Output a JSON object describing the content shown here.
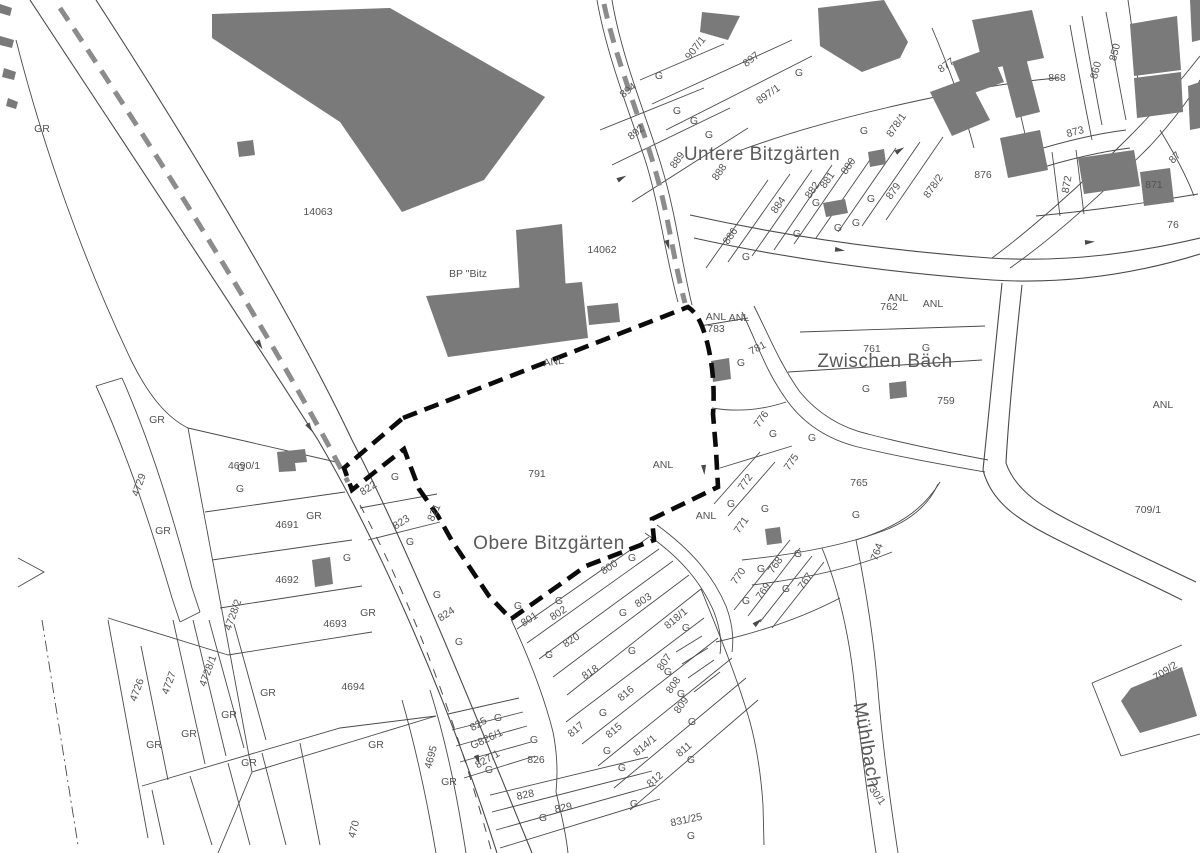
{
  "map": {
    "colors": {
      "background": "#ffffff",
      "building_fill": "#7a7a7a",
      "parcel_line": "#4a4a4a",
      "site_boundary": "#0b0b0b",
      "wall_dash": "#8c8c8c",
      "label_text": "#525252",
      "place_text": "#5a5a5a"
    },
    "place_names": [
      {
        "name": "label-untere-bitzgaerten",
        "t": "Untere Bitzgärten",
        "x": 762,
        "y": 160,
        "r": 0
      },
      {
        "name": "label-obere-bitzgaerten",
        "t": "Obere Bitzgärten",
        "x": 549,
        "y": 549,
        "r": 0
      },
      {
        "name": "label-zwischen-baech",
        "t": "Zwischen Bäch",
        "x": 885,
        "y": 367,
        "r": 0
      },
      {
        "name": "label-muehlbach",
        "t": "Mühlbach",
        "x": 861,
        "y": 746,
        "r": 80,
        "fs": 13
      }
    ],
    "labels": [
      {
        "t": "GR",
        "x": 42,
        "y": 132
      },
      {
        "t": "14063",
        "x": 318,
        "y": 215
      },
      {
        "t": "BP \"Bitz",
        "x": 468,
        "y": 277,
        "under": true,
        "name": "label-bp-bitzgaerten"
      },
      {
        "t": "14062",
        "x": 602,
        "y": 253
      },
      {
        "t": "GR",
        "x": 157,
        "y": 423
      },
      {
        "t": "4729",
        "x": 142,
        "y": 486,
        "r": -70
      },
      {
        "t": "4690/1",
        "x": 244,
        "y": 469
      },
      {
        "t": "G",
        "x": 241,
        "y": 471
      },
      {
        "t": "G",
        "x": 240,
        "y": 492
      },
      {
        "t": "GR",
        "x": 314,
        "y": 519
      },
      {
        "t": "4691",
        "x": 287,
        "y": 528
      },
      {
        "t": "GR",
        "x": 163,
        "y": 534
      },
      {
        "t": "G",
        "x": 347,
        "y": 561
      },
      {
        "t": "4692",
        "x": 287,
        "y": 583
      },
      {
        "t": "4693",
        "x": 335,
        "y": 627
      },
      {
        "t": "GR",
        "x": 368,
        "y": 616
      },
      {
        "t": "4694",
        "x": 353,
        "y": 690
      },
      {
        "t": "4728/2",
        "x": 236,
        "y": 616,
        "r": -70
      },
      {
        "t": "4728/1",
        "x": 211,
        "y": 672,
        "r": -70
      },
      {
        "t": "4727",
        "x": 172,
        "y": 684,
        "r": -70
      },
      {
        "t": "4726",
        "x": 140,
        "y": 691,
        "r": -70
      },
      {
        "t": "GR",
        "x": 268,
        "y": 696
      },
      {
        "t": "GR",
        "x": 229,
        "y": 718
      },
      {
        "t": "GR",
        "x": 189,
        "y": 737
      },
      {
        "t": "GR",
        "x": 154,
        "y": 748
      },
      {
        "t": "GR",
        "x": 249,
        "y": 766
      },
      {
        "t": "GR",
        "x": 376,
        "y": 748
      },
      {
        "t": "GR",
        "x": 449,
        "y": 785
      },
      {
        "t": "4695",
        "x": 434,
        "y": 758,
        "r": -75
      },
      {
        "t": "470",
        "x": 357,
        "y": 830,
        "r": -75
      },
      {
        "t": "822",
        "x": 370,
        "y": 491,
        "r": -33
      },
      {
        "t": "G",
        "x": 395,
        "y": 480
      },
      {
        "t": "823",
        "x": 403,
        "y": 525,
        "r": -33
      },
      {
        "t": "G",
        "x": 410,
        "y": 545
      },
      {
        "t": "821",
        "x": 437,
        "y": 514,
        "r": -65
      },
      {
        "t": "824",
        "x": 448,
        "y": 617,
        "r": -33
      },
      {
        "t": "G",
        "x": 437,
        "y": 598
      },
      {
        "t": "G",
        "x": 459,
        "y": 645
      },
      {
        "t": "791",
        "x": 537,
        "y": 477,
        "name": "parcel-791-site"
      },
      {
        "t": "ANL",
        "x": 554,
        "y": 365,
        "r": -8
      },
      {
        "t": "ANL",
        "x": 663,
        "y": 468
      },
      {
        "t": "ANL",
        "x": 706,
        "y": 519
      },
      {
        "t": "ANL",
        "x": 716,
        "y": 320
      },
      {
        "t": "783",
        "x": 716,
        "y": 332
      },
      {
        "t": "ANL",
        "x": 739,
        "y": 321
      },
      {
        "t": "801",
        "x": 531,
        "y": 622,
        "r": -33
      },
      {
        "t": "G",
        "x": 518,
        "y": 609
      },
      {
        "t": "802",
        "x": 560,
        "y": 616,
        "r": -33
      },
      {
        "t": "G",
        "x": 559,
        "y": 604
      },
      {
        "t": "800",
        "x": 611,
        "y": 570,
        "r": -33
      },
      {
        "t": "G",
        "x": 632,
        "y": 561
      },
      {
        "t": "803",
        "x": 645,
        "y": 603,
        "r": -33
      },
      {
        "t": "G",
        "x": 623,
        "y": 616
      },
      {
        "t": "820",
        "x": 573,
        "y": 643,
        "r": -33
      },
      {
        "t": "G",
        "x": 549,
        "y": 658
      },
      {
        "t": "818",
        "x": 592,
        "y": 675,
        "r": -33
      },
      {
        "t": "G",
        "x": 632,
        "y": 654
      },
      {
        "t": "818/1",
        "x": 678,
        "y": 621,
        "r": -40
      },
      {
        "t": "G",
        "x": 686,
        "y": 631
      },
      {
        "t": "807",
        "x": 667,
        "y": 664,
        "r": -55
      },
      {
        "t": "G",
        "x": 668,
        "y": 675
      },
      {
        "t": "808",
        "x": 676,
        "y": 687,
        "r": -55
      },
      {
        "t": "G",
        "x": 681,
        "y": 697
      },
      {
        "t": "809",
        "x": 684,
        "y": 707,
        "r": -55
      },
      {
        "t": "G",
        "x": 692,
        "y": 725
      },
      {
        "t": "816",
        "x": 628,
        "y": 696,
        "r": -40
      },
      {
        "t": "G",
        "x": 603,
        "y": 716
      },
      {
        "t": "817",
        "x": 578,
        "y": 732,
        "r": -40
      },
      {
        "t": "815",
        "x": 616,
        "y": 733,
        "r": -40
      },
      {
        "t": "G",
        "x": 607,
        "y": 754
      },
      {
        "t": "814/1",
        "x": 647,
        "y": 748,
        "r": -40
      },
      {
        "t": "G",
        "x": 622,
        "y": 771
      },
      {
        "t": "811",
        "x": 686,
        "y": 752,
        "r": -40
      },
      {
        "t": "G",
        "x": 691,
        "y": 763
      },
      {
        "t": "812",
        "x": 657,
        "y": 782,
        "r": -40
      },
      {
        "t": "G",
        "x": 634,
        "y": 807
      },
      {
        "t": "831/25",
        "x": 687,
        "y": 823,
        "r": -12
      },
      {
        "t": "G",
        "x": 691,
        "y": 839
      },
      {
        "t": "828",
        "x": 526,
        "y": 798,
        "r": -12
      },
      {
        "t": "829",
        "x": 564,
        "y": 811,
        "r": -12
      },
      {
        "t": "G",
        "x": 543,
        "y": 821
      },
      {
        "t": "825",
        "x": 480,
        "y": 727,
        "r": -30
      },
      {
        "t": "G",
        "x": 498,
        "y": 721
      },
      {
        "t": "G826/1",
        "x": 488,
        "y": 742,
        "r": -25
      },
      {
        "t": "827/1",
        "x": 489,
        "y": 762,
        "r": -30
      },
      {
        "t": "G",
        "x": 489,
        "y": 773
      },
      {
        "t": "826",
        "x": 536,
        "y": 763
      },
      {
        "t": "G",
        "x": 534,
        "y": 743
      },
      {
        "t": "781",
        "x": 759,
        "y": 351,
        "r": -28
      },
      {
        "t": "G",
        "x": 741,
        "y": 366
      },
      {
        "t": "776",
        "x": 764,
        "y": 421,
        "r": -55
      },
      {
        "t": "G",
        "x": 773,
        "y": 437
      },
      {
        "t": "G",
        "x": 812,
        "y": 441
      },
      {
        "t": "775",
        "x": 794,
        "y": 464,
        "r": -55
      },
      {
        "t": "772",
        "x": 748,
        "y": 484,
        "r": -55
      },
      {
        "t": "G",
        "x": 731,
        "y": 507
      },
      {
        "t": "G",
        "x": 765,
        "y": 512
      },
      {
        "t": "771",
        "x": 744,
        "y": 527,
        "r": -55
      },
      {
        "t": "770",
        "x": 741,
        "y": 578,
        "r": -55
      },
      {
        "t": "G",
        "x": 746,
        "y": 604
      },
      {
        "t": "768",
        "x": 778,
        "y": 567,
        "r": -55
      },
      {
        "t": "G",
        "x": 761,
        "y": 572
      },
      {
        "t": "769",
        "x": 766,
        "y": 593,
        "r": -55
      },
      {
        "t": "G",
        "x": 786,
        "y": 592
      },
      {
        "t": "767",
        "x": 808,
        "y": 583,
        "r": -55
      },
      {
        "t": "G",
        "x": 798,
        "y": 557
      },
      {
        "t": "764",
        "x": 880,
        "y": 553,
        "r": -70
      },
      {
        "t": "765",
        "x": 859,
        "y": 486
      },
      {
        "t": "G",
        "x": 856,
        "y": 518
      },
      {
        "t": "ANL",
        "x": 898,
        "y": 301
      },
      {
        "t": "762",
        "x": 889,
        "y": 310
      },
      {
        "t": "ANL",
        "x": 933,
        "y": 307
      },
      {
        "t": "761",
        "x": 872,
        "y": 352
      },
      {
        "t": "G",
        "x": 926,
        "y": 351
      },
      {
        "t": "759",
        "x": 946,
        "y": 404
      },
      {
        "t": "G",
        "x": 866,
        "y": 392
      },
      {
        "t": "730/1",
        "x": 873,
        "y": 795,
        "r": 55
      },
      {
        "t": "ANL",
        "x": 1163,
        "y": 408
      },
      {
        "t": "709/1",
        "x": 1148,
        "y": 513
      },
      {
        "t": "709/2",
        "x": 1167,
        "y": 674,
        "r": -33
      },
      {
        "t": "907/1",
        "x": 698,
        "y": 50,
        "r": -52
      },
      {
        "t": "897",
        "x": 753,
        "y": 62,
        "r": -38
      },
      {
        "t": "897/1",
        "x": 770,
        "y": 97,
        "r": -35
      },
      {
        "t": "G",
        "x": 799,
        "y": 76
      },
      {
        "t": "894",
        "x": 630,
        "y": 93,
        "r": -38
      },
      {
        "t": "G",
        "x": 659,
        "y": 79
      },
      {
        "t": "892",
        "x": 638,
        "y": 135,
        "r": -38
      },
      {
        "t": "G",
        "x": 677,
        "y": 114
      },
      {
        "t": "G",
        "x": 694,
        "y": 124
      },
      {
        "t": "G",
        "x": 709,
        "y": 138
      },
      {
        "t": "889",
        "x": 680,
        "y": 162,
        "r": -55
      },
      {
        "t": "888",
        "x": 722,
        "y": 174,
        "r": -55
      },
      {
        "t": "886",
        "x": 733,
        "y": 238,
        "r": -55
      },
      {
        "t": "G",
        "x": 746,
        "y": 260
      },
      {
        "t": "884",
        "x": 781,
        "y": 207,
        "r": -55
      },
      {
        "t": "G",
        "x": 797,
        "y": 237
      },
      {
        "t": "882",
        "x": 815,
        "y": 192,
        "r": -55
      },
      {
        "t": "G",
        "x": 816,
        "y": 206
      },
      {
        "t": "881",
        "x": 830,
        "y": 182,
        "r": -55
      },
      {
        "t": "880",
        "x": 851,
        "y": 168,
        "r": -55
      },
      {
        "t": "G",
        "x": 864,
        "y": 134
      },
      {
        "t": "G",
        "x": 871,
        "y": 202
      },
      {
        "t": "G",
        "x": 838,
        "y": 231
      },
      {
        "t": "G",
        "x": 856,
        "y": 226
      },
      {
        "t": "879",
        "x": 896,
        "y": 193,
        "r": -55
      },
      {
        "t": "878/1",
        "x": 899,
        "y": 127,
        "r": -55
      },
      {
        "t": "878/2",
        "x": 936,
        "y": 188,
        "r": -55
      },
      {
        "t": "877",
        "x": 948,
        "y": 68,
        "r": -35
      },
      {
        "t": "868",
        "x": 1057,
        "y": 81
      },
      {
        "t": "850",
        "x": 1118,
        "y": 53,
        "r": -75
      },
      {
        "t": "860",
        "x": 1099,
        "y": 71,
        "r": -75
      },
      {
        "t": "873",
        "x": 1076,
        "y": 135,
        "r": -15
      },
      {
        "t": "876",
        "x": 983,
        "y": 178
      },
      {
        "t": "872",
        "x": 1070,
        "y": 185,
        "r": -80
      },
      {
        "t": "871",
        "x": 1154,
        "y": 188
      },
      {
        "t": "87",
        "x": 1177,
        "y": 160,
        "r": -45
      },
      {
        "t": "76",
        "x": 1173,
        "y": 228
      }
    ]
  }
}
